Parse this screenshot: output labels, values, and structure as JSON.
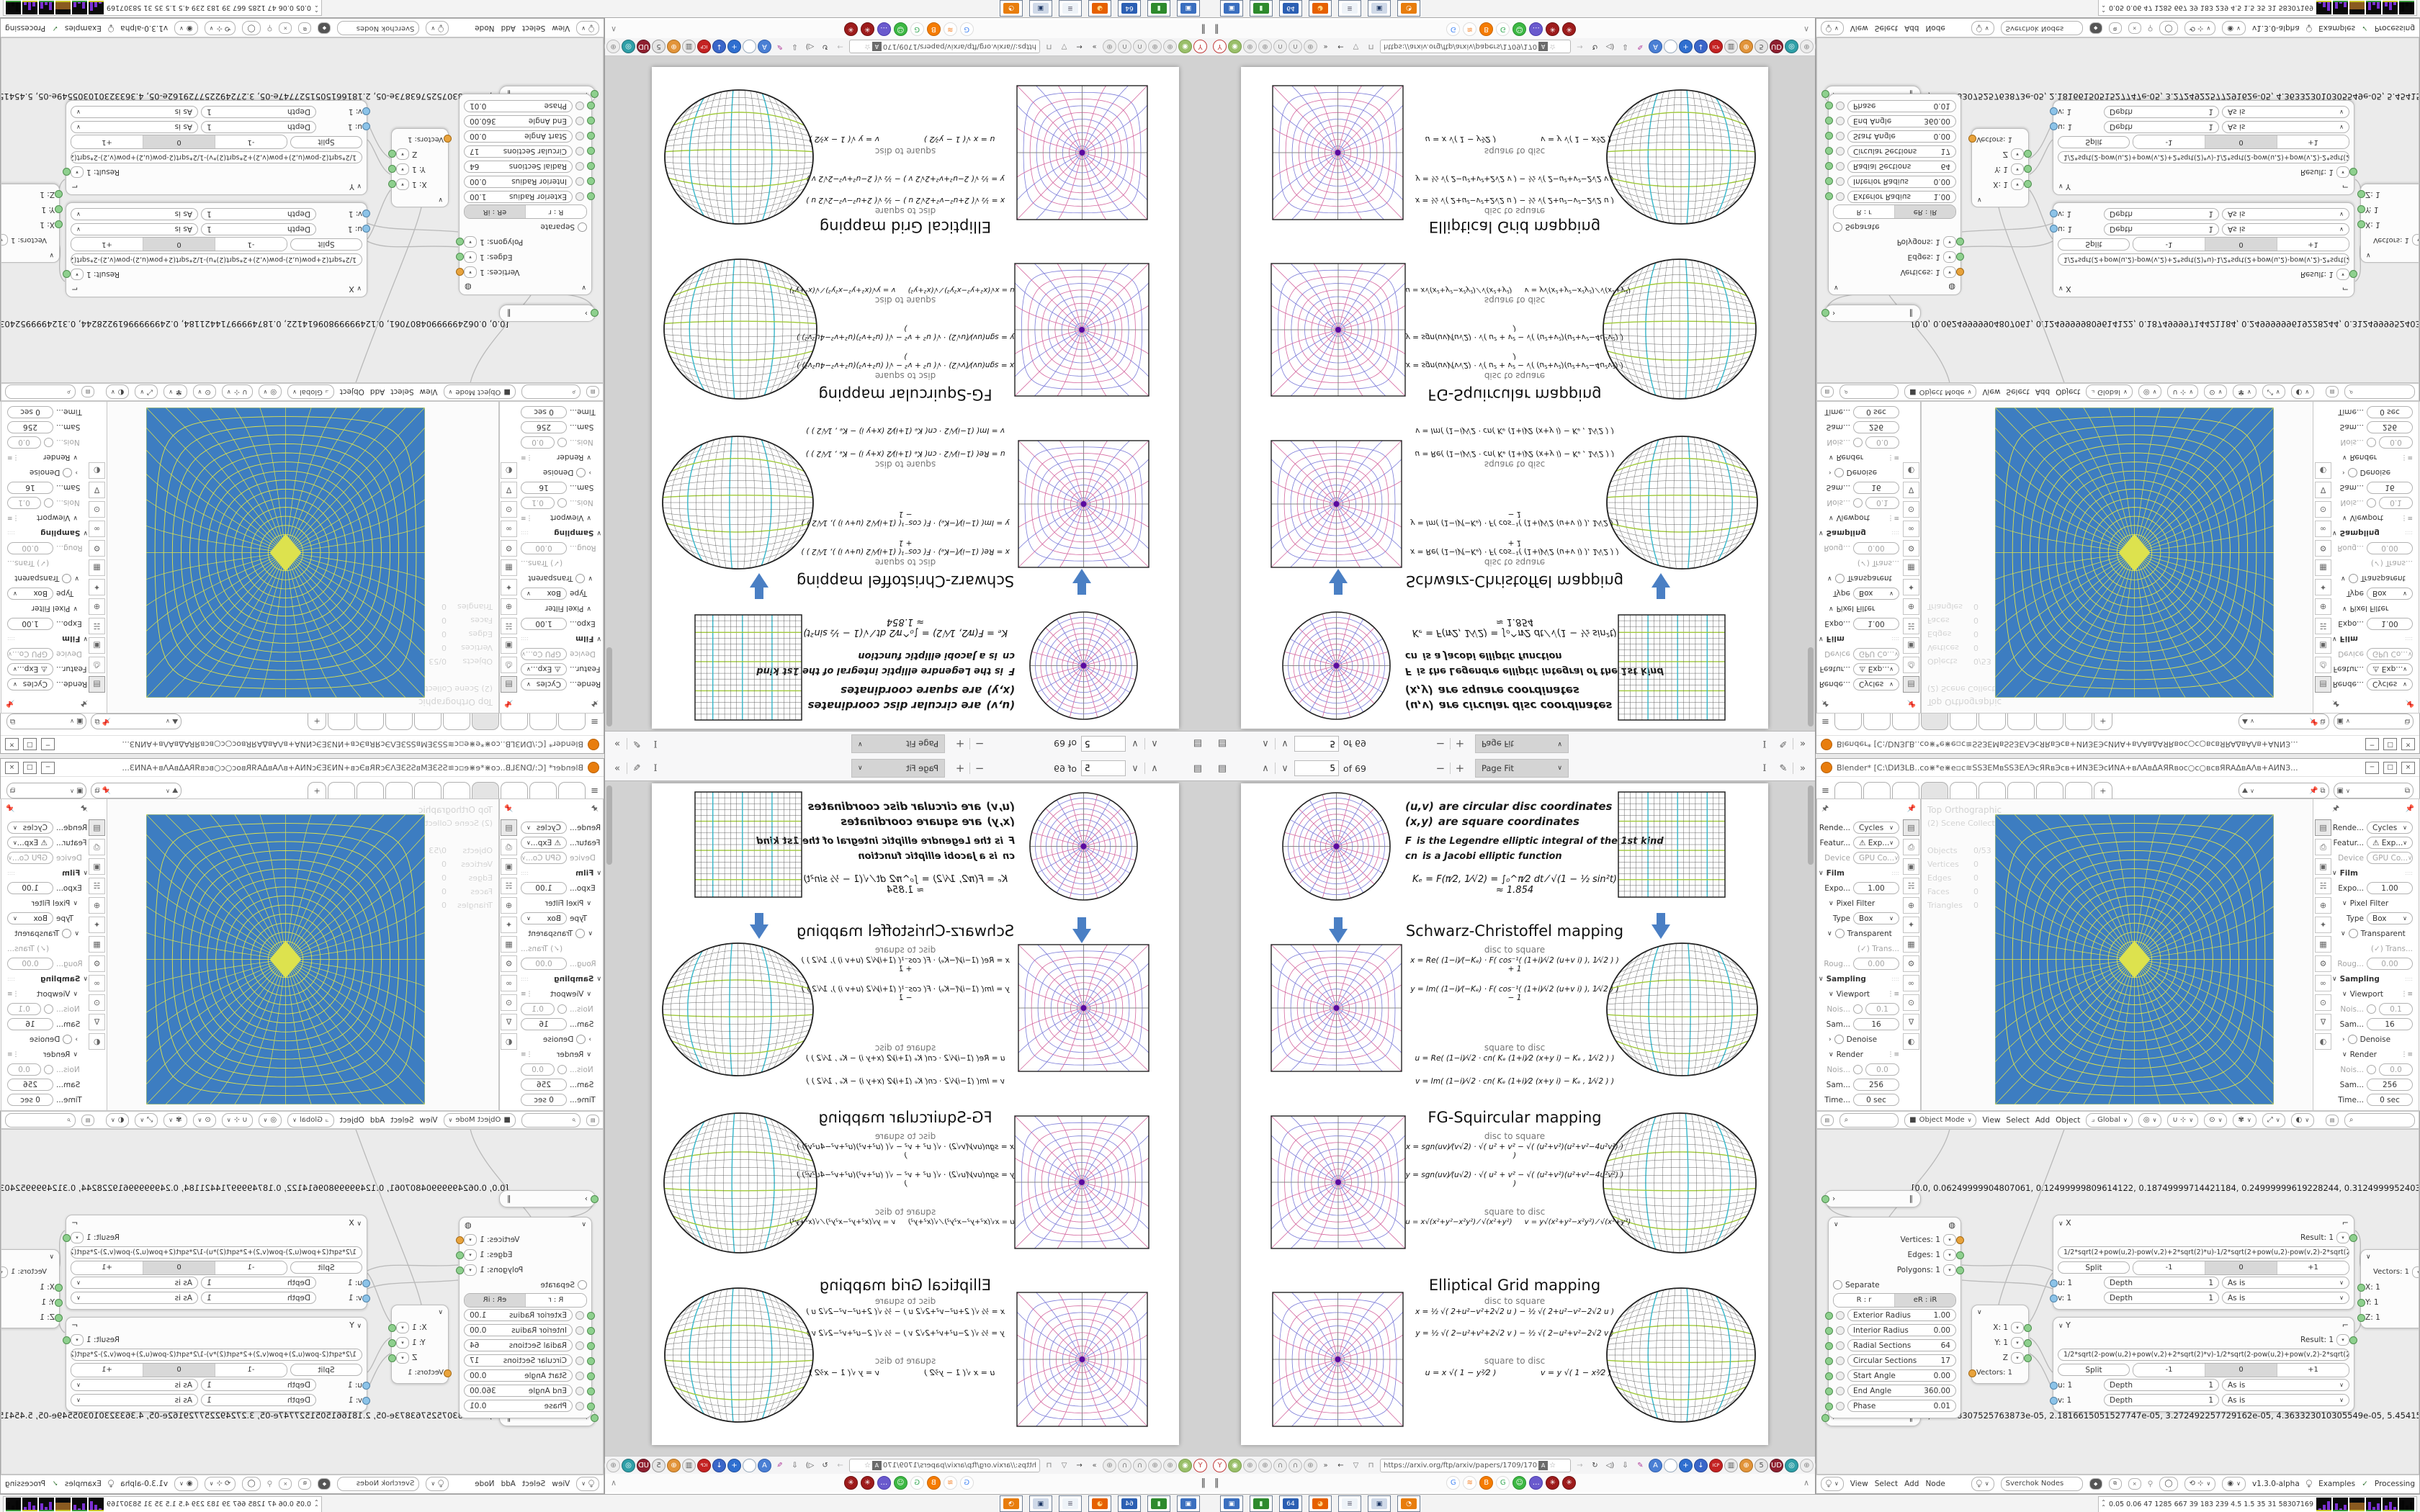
{
  "pdf_viewer": {
    "toolbar": {
      "page_input": "5",
      "of_label": "of 69",
      "zoom_select": "Page Fit"
    },
    "url": "https://arxiv.org/ftp/arxiv/papers/1709/170",
    "page": {
      "legend": [
        {
          "head": "(u,v)",
          "rest": "are circular disc coordinates"
        },
        {
          "head": "(x,y)",
          "rest": "are square coordinates"
        },
        {
          "head": "F",
          "rest": "is the Legendre elliptic integral of the 1st kind"
        },
        {
          "head": "cn",
          "rest": "is a Jacobi elliptic function"
        }
      ],
      "k_formula": "Kₑ = F(π⁄2, 1⁄√2) = ∫₀^π⁄2 dt ⁄ √(1 − ½ sin²t)  ≈ 1.854",
      "sections": [
        {
          "title": "Schwarz-Christoffel mapping",
          "ds_label": "disc to square",
          "sd_label": "square to disc",
          "ds": [
            "x = Re( (1−i)⁄(−Kₑ) · F( cos⁻¹( (1+i)⁄√2 (u+v i) ), 1⁄√2 ) ) + 1",
            "y = Im( (1−i)⁄(−Kₑ) · F( cos⁻¹( (1+i)⁄√2 (u+v i) ), 1⁄√2 ) ) − 1"
          ],
          "sd": [
            "u = Re( (1−i)⁄√2 · cn( Kₑ (1+i)⁄2 (x+y i) − Kₑ , 1⁄√2 ) )",
            "v = Im( (1−i)⁄√2 · cn( Kₑ (1+i)⁄2 (x+y i) − Kₑ , 1⁄√2 ) )"
          ]
        },
        {
          "title": "FG-Squircular mapping",
          "ds_label": "disc to square",
          "sd_label": "square to disc",
          "ds": [
            "x = sgn(uv)⁄(v√2) · √( u² + v² − √( (u²+v²)(u²+v²−4u²v²) ) )",
            "y = sgn(uv)⁄(u√2) · √( u² + v² − √( (u²+v²)(u²+v²−4u²v²) ) )"
          ],
          "sd": [
            "u = x√(x²+y²−x²y²) ⁄ √(x²+y²)",
            "v = y√(x²+y²−x²y²) ⁄ √(x²+y²)"
          ]
        },
        {
          "title": "Elliptical Grid mapping",
          "ds_label": "disc to square",
          "sd_label": "square to disc",
          "ds": [
            "x = ½ √( 2+u²−v²+2√2 u )  −  ½ √( 2+u²−v²−2√2 u )",
            "y = ½ √( 2−u²+v²+2√2 v )  −  ½ √( 2−u²+v²−2√2 v )"
          ],
          "sd": [
            "u = x √( 1 − y²⁄2 )",
            "v = y √( 1 − x²⁄2 )"
          ]
        }
      ]
    },
    "nav_icons": [
      {
        "name": "y-pin-icon",
        "glyph": "Y",
        "fg": "#c23b3b",
        "bg": "#fff",
        "bd": "#c23b3b"
      },
      {
        "name": "green-addon-icon",
        "glyph": "◉",
        "fg": "#fff",
        "bg": "#9abf6a",
        "bd": "#7ba04b"
      },
      {
        "name": "globe-icon",
        "glyph": "⊕",
        "fg": "#8a8a8a",
        "bg": "#ededed",
        "bd": "#bbb"
      },
      {
        "name": "globe-icon-2",
        "glyph": "⊕",
        "fg": "#8a8a8a",
        "bg": "#ededed",
        "bd": "#bbb"
      },
      {
        "name": "headset-icon",
        "glyph": "∩",
        "fg": "#7a7a7a",
        "bg": "#ededed",
        "bd": "#bbb"
      },
      {
        "name": "headset-icon-2",
        "glyph": "∩",
        "fg": "#7a7a7a",
        "bg": "#ededed",
        "bd": "#bbb"
      },
      {
        "name": "globe-icon-3",
        "glyph": "⊕",
        "fg": "#8a8a8a",
        "bg": "#ededed",
        "bd": "#bbb"
      },
      {
        "name": "overflow-icon",
        "glyph": "»",
        "fg": "#555",
        "bg": "transparent",
        "bd": "transparent"
      },
      {
        "name": "back-icon",
        "glyph": "←",
        "fg": "#3a3a3a",
        "bg": "transparent",
        "bd": "transparent"
      },
      {
        "name": "shield-icon",
        "glyph": "▽",
        "fg": "#777",
        "bg": "transparent",
        "bd": "transparent"
      },
      {
        "name": "lock-icon",
        "glyph": "⊓",
        "fg": "#777",
        "bg": "transparent",
        "bd": "transparent"
      }
    ],
    "nav_icons_right": [
      {
        "name": "forward-icon",
        "glyph": "→",
        "fg": "#b5b5b5",
        "bg": "transparent",
        "bd": "transparent"
      },
      {
        "name": "reload-icon",
        "glyph": "↻",
        "fg": "#444",
        "bg": "transparent",
        "bd": "transparent"
      },
      {
        "name": "speaker-icon",
        "glyph": "◁)",
        "fg": "#555",
        "bg": "transparent",
        "bd": "transparent"
      },
      {
        "name": "download-icon",
        "glyph": "⇩",
        "fg": "#555",
        "bg": "transparent",
        "bd": "transparent"
      },
      {
        "name": "brush-icon",
        "glyph": "✎",
        "fg": "#b03a9a",
        "bg": "transparent",
        "bd": "transparent"
      },
      {
        "name": "translate-icon",
        "glyph": "A",
        "fg": "#fff",
        "bg": "#4a7fd4",
        "bd": "#2f5fb0"
      },
      {
        "name": "oval-addon-icon",
        "glyph": "",
        "fg": "#888",
        "bg": "#fff",
        "bd": "#9ab"
      },
      {
        "name": "plus-addon-icon",
        "glyph": "+",
        "fg": "#fff",
        "bg": "#2f6fd0",
        "bd": "#1f4f9f"
      },
      {
        "name": "down-addon-icon",
        "glyph": "↓",
        "fg": "#fff",
        "bg": "#3a66c9",
        "bd": "#24479c"
      },
      {
        "name": "icp-addon-icon",
        "glyph": "ICP",
        "fg": "#fff",
        "bg": "#c42222",
        "bd": "#8f1616"
      },
      {
        "name": "trash-icon",
        "glyph": "▥",
        "fg": "#555",
        "bg": "#e9e9e9",
        "bd": "#aaa"
      },
      {
        "name": "globe-orange-icon",
        "glyph": "⊕",
        "fg": "#fff",
        "bg": "#e2943a",
        "bd": "#b06f1f"
      },
      {
        "name": "five-box-icon",
        "glyph": "5",
        "fg": "#555",
        "bg": "#e5e5e5",
        "bd": "#999"
      },
      {
        "name": "ud-shield-icon",
        "glyph": "UD",
        "fg": "#fff",
        "bg": "#8f1f2f",
        "bd": "#5f1420"
      },
      {
        "name": "teal-addon-icon",
        "glyph": "◎",
        "fg": "#fff",
        "bg": "#2fa0a8",
        "bd": "#1f7078"
      },
      {
        "name": "globe-gray-icon",
        "glyph": "⊕",
        "fg": "#888",
        "bg": "#ededed",
        "bd": "#bbb"
      },
      {
        "name": "thumb-icon",
        "glyph": "↥",
        "fg": "#666",
        "bg": "#f2f2f2",
        "bd": "#bbb"
      },
      {
        "name": "wrench-icon",
        "glyph": "⌐",
        "fg": "#666",
        "bg": "transparent",
        "bd": "transparent"
      },
      {
        "name": "gear-icon",
        "glyph": "⚙",
        "fg": "#666",
        "bg": "transparent",
        "bd": "transparent"
      }
    ],
    "bookmarks": [
      {
        "name": "google-bookmark-icon",
        "glyph": "G",
        "fg": "#4285f4",
        "bg": "#fff",
        "bd": "#ddd"
      },
      {
        "name": "stackoverflow-bookmark-icon",
        "glyph": "≋",
        "fg": "#f48024",
        "bg": "#fff",
        "bd": "#ddd"
      },
      {
        "name": "blogger-bookmark-icon",
        "glyph": "B",
        "fg": "#fff",
        "bg": "#f57c00",
        "bd": "#c96400"
      },
      {
        "name": "google2-bookmark-icon",
        "glyph": "G",
        "fg": "#34a853",
        "bg": "#fff",
        "bd": "#ddd"
      },
      {
        "name": "smiley-bookmark-icon",
        "glyph": "☺",
        "fg": "#fff",
        "bg": "#3cb843",
        "bd": "#2a8f30"
      },
      {
        "name": "chat-bookmark-icon",
        "glyph": "…",
        "fg": "#fff",
        "bg": "#6a5acd",
        "bd": "#4a3aad"
      },
      {
        "name": "gear-flower-icon",
        "glyph": "✳",
        "fg": "#fff",
        "bg": "#9d1b1b",
        "bd": "#6d1010"
      },
      {
        "name": "gear-flower-icon-2",
        "glyph": "✳",
        "fg": "#fff",
        "bg": "#9d1b1b",
        "bd": "#6d1010"
      }
    ]
  },
  "blender": {
    "title": "Blender* [C:\\DИЗLB..cо⋇*е⋇е▫c≋SSЗEMвSSЗEΛЭcЯRвЭcв+ИNЗEЭсИNA+вΛAвΔAЯRвоc○c○вcвЯRAΔвAΛв+AИNЗ...",
    "window_buttons": [
      "─",
      "□",
      "×"
    ],
    "scene_selector_icon": "scene-icon",
    "view_layer_selector_icon": "view-layer-icon",
    "properties_rows": [
      {
        "type": "select",
        "label": "Rende...",
        "value": "Cycles"
      },
      {
        "type": "select",
        "label": "Featur...",
        "value": "⚠ Exp..."
      },
      {
        "type": "select",
        "label": "Device",
        "value": "GPU Co...",
        "dim": true
      },
      {
        "type": "section",
        "label": "Film"
      },
      {
        "type": "field",
        "label": "Expo...",
        "value": "1.00"
      },
      {
        "type": "subsection",
        "label": "Pixel Filter"
      },
      {
        "type": "select",
        "label": "Type",
        "value": "Box"
      },
      {
        "type": "subcheck",
        "label": "Transparent"
      },
      {
        "type": "checkdim",
        "label": "Trans..."
      },
      {
        "type": "field",
        "label": "Roug...",
        "value": "0.00",
        "dim": true
      },
      {
        "type": "section",
        "label": "Sampling"
      },
      {
        "type": "subicons",
        "label": "Viewport"
      },
      {
        "type": "fieldcheck",
        "label": "Nois...",
        "value": "0.1",
        "dim": true
      },
      {
        "type": "field",
        "label": "Sam...",
        "value": "16"
      },
      {
        "type": "collapsed",
        "label": "Denoise"
      },
      {
        "type": "subicons",
        "label": "Render"
      },
      {
        "type": "fieldcheck",
        "label": "Nois...",
        "value": "0.0",
        "dim": true
      },
      {
        "type": "field",
        "label": "Sam...",
        "value": "256"
      },
      {
        "type": "field",
        "label": "Time...",
        "value": "0 sec"
      }
    ],
    "prop_tabs": [
      "▤",
      "⎙",
      "▣",
      "☵",
      "⊕",
      "✦",
      "▦",
      "⚙",
      "∞",
      "⊙",
      "∇",
      "◐"
    ],
    "viewport": {
      "view_label": "Top Orthographic",
      "scene_label": "(2) Scene Collection |  ☼ # ◯ ⊙ ◯ ⊙ ◯ # ⊙",
      "stats": [
        [
          "Objects",
          "0/53"
        ],
        [
          "Vertices",
          "0"
        ],
        [
          "Edges",
          "0"
        ],
        [
          "Faces",
          "0"
        ],
        [
          "Triangles",
          "0"
        ]
      ],
      "header": {
        "mode": "Object Mode",
        "menus": [
          "View",
          "Select",
          "Add",
          "Object"
        ],
        "orientation": "Global"
      }
    },
    "node_editor": {
      "array_text_1": "[0.0, 0.06249999904807061, 0.12499999809614122, 0.18749999714421184, 0.24999999619228244, 0.31249999524035305, 0.374",
      "array_text_2": "[0.0, 1.0908307525763873e-05, 2.1816615051527747e-05, 3.272492257729162e-05, 4.363323010305549e-05, 5.454153762881936",
      "torus": {
        "outputs": [
          [
            "Vertices: 1",
            "orange"
          ],
          [
            "Edges: 1",
            "green"
          ],
          [
            "Polygons: 1",
            "green"
          ]
        ],
        "separate_label": "Separate",
        "mode_a": "R : r",
        "mode_b": "eR : iR",
        "sliders": [
          [
            "Exterior Radius",
            "1.00"
          ],
          [
            "Interior Radius",
            "0.00"
          ],
          [
            "Radial Sections",
            "64"
          ],
          [
            "Circular Sections",
            "17"
          ],
          [
            "Start Angle",
            "0.00"
          ],
          [
            "End Angle",
            "360.00"
          ],
          [
            "Phase",
            "0.01"
          ]
        ]
      },
      "vector_in": {
        "inputs": [
          "X: 1",
          "Y: 1",
          "Z"
        ],
        "output": "Vectors: 1"
      },
      "vector_right": {
        "output": "Vectors: 1",
        "inputs": [
          "X: 1",
          "Y: 1",
          "Z: 1"
        ]
      },
      "formula_x": {
        "name": "X",
        "result": "Result: 1",
        "expr": "1/2*sqrt(2+pow(u,2)-pow(v,2)+2*sqrt(2)*u)-1/2*sqrt(2+pow(u,2)-pow(v,2)-2*sqrt(2)*u)",
        "split": "Split",
        "segments": [
          "-1",
          "0",
          "+1"
        ],
        "inputs": [
          [
            "u: 1",
            "Depth",
            "1",
            "As is"
          ],
          [
            "v: 1",
            "Depth",
            "1",
            "As is"
          ]
        ]
      },
      "formula_y": {
        "name": "Y",
        "result": "Result: 1",
        "expr": "1/2*sqrt(2-pow(u,2)+pow(v,2)+2*sqrt(2)*v)-1/2*sqrt(2-pow(u,2)+pow(v,2)-2*sqrt(2)*v)",
        "split": "Split",
        "segments": [
          "-1",
          "0",
          "+1"
        ],
        "inputs": [
          [
            "u: 1",
            "Depth",
            "1",
            "As is"
          ],
          [
            "v: 1",
            "Depth",
            "1",
            "As is"
          ]
        ]
      },
      "header": {
        "menus": [
          "View",
          "Select",
          "Add",
          "Node"
        ],
        "tree_name": "Sverchok Nodes",
        "version": "v1.3.0-alpha",
        "examples": "Examples",
        "processing": "Processing"
      }
    }
  },
  "taskbar": {
    "app_icons": [
      {
        "name": "display-app-icon",
        "glyph": "▣",
        "fg": "#fff",
        "bg": "#3a6fbf"
      },
      {
        "name": "green-utility-app-icon",
        "glyph": "▮",
        "fg": "#dfd",
        "bg": "#2d8a2d"
      },
      {
        "name": "floppy-64-app-icon",
        "glyph": "64",
        "fg": "#fff",
        "bg": "#2b5fb3"
      },
      {
        "name": "firefox-app-icon",
        "glyph": "◕",
        "fg": "#ffd27f",
        "bg": "#e66000"
      },
      {
        "name": "notepad-app-icon",
        "glyph": "≣",
        "fg": "#667",
        "bg": "#eef3f8"
      },
      {
        "name": "window-app-icon",
        "glyph": "▣",
        "fg": "#223a66",
        "bg": "#cfd9e8"
      },
      {
        "name": "blender-app-icon",
        "glyph": "◔",
        "fg": "#fff",
        "bg": "#e87d0d"
      }
    ],
    "stats_text": "0.05 0.06   47   1285 667   39   183   239   4.5   1.5   35   31   58307169"
  },
  "colors": {
    "viewport_blue": "#3d7dc1",
    "grid_yellow": "#dde24e",
    "accent_arrow": "#4a7fc4",
    "fig_pink": "#d4679f",
    "fig_blue": "#7b7bd8",
    "fig_green": "#9fc83a",
    "fig_cyan": "#35b6c9"
  }
}
